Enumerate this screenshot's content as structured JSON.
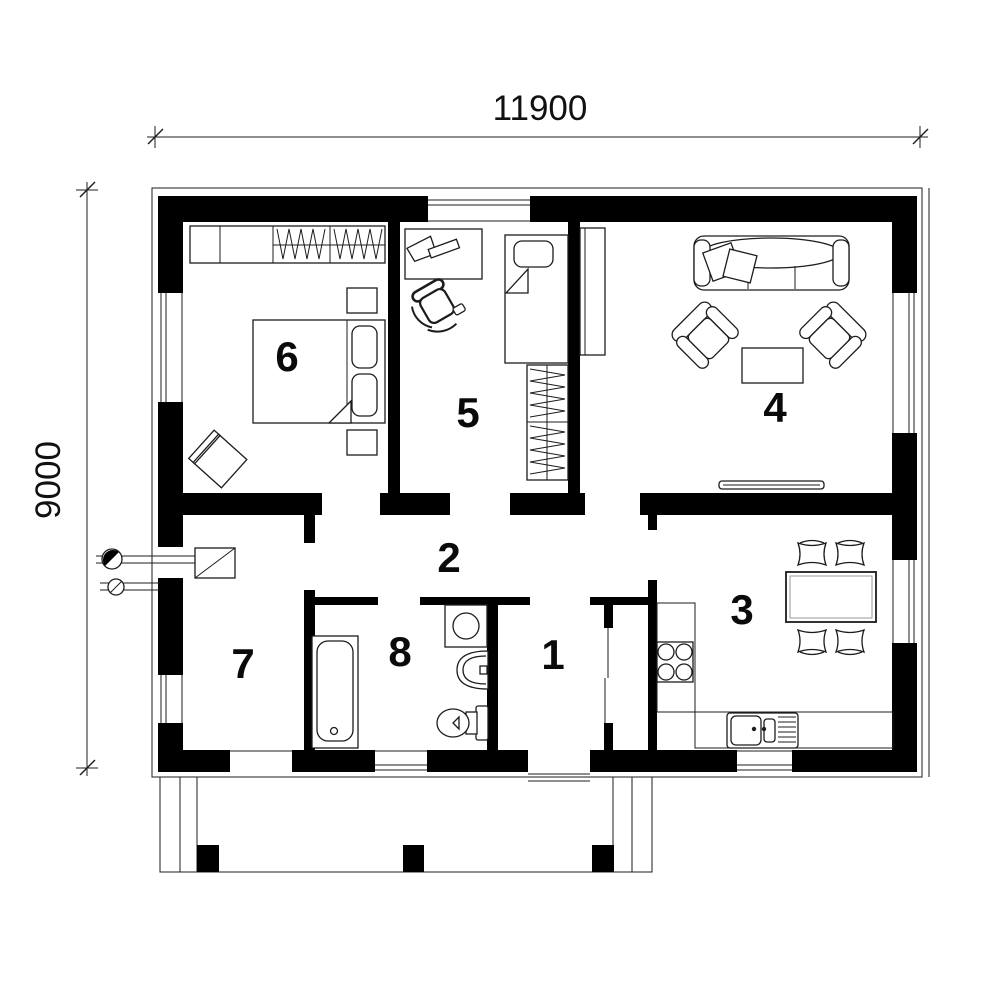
{
  "drawing": {
    "kind": "floor-plan",
    "colors": {
      "background": "#ffffff",
      "walls": "#000000",
      "lines": "#1c1c1c"
    }
  },
  "dimensions": {
    "width": "11900",
    "height": "9000"
  },
  "rooms": [
    {
      "label": "1"
    },
    {
      "label": "2"
    },
    {
      "label": "3"
    },
    {
      "label": "4"
    },
    {
      "label": "5"
    },
    {
      "label": "6"
    },
    {
      "label": "7"
    },
    {
      "label": "8"
    }
  ]
}
